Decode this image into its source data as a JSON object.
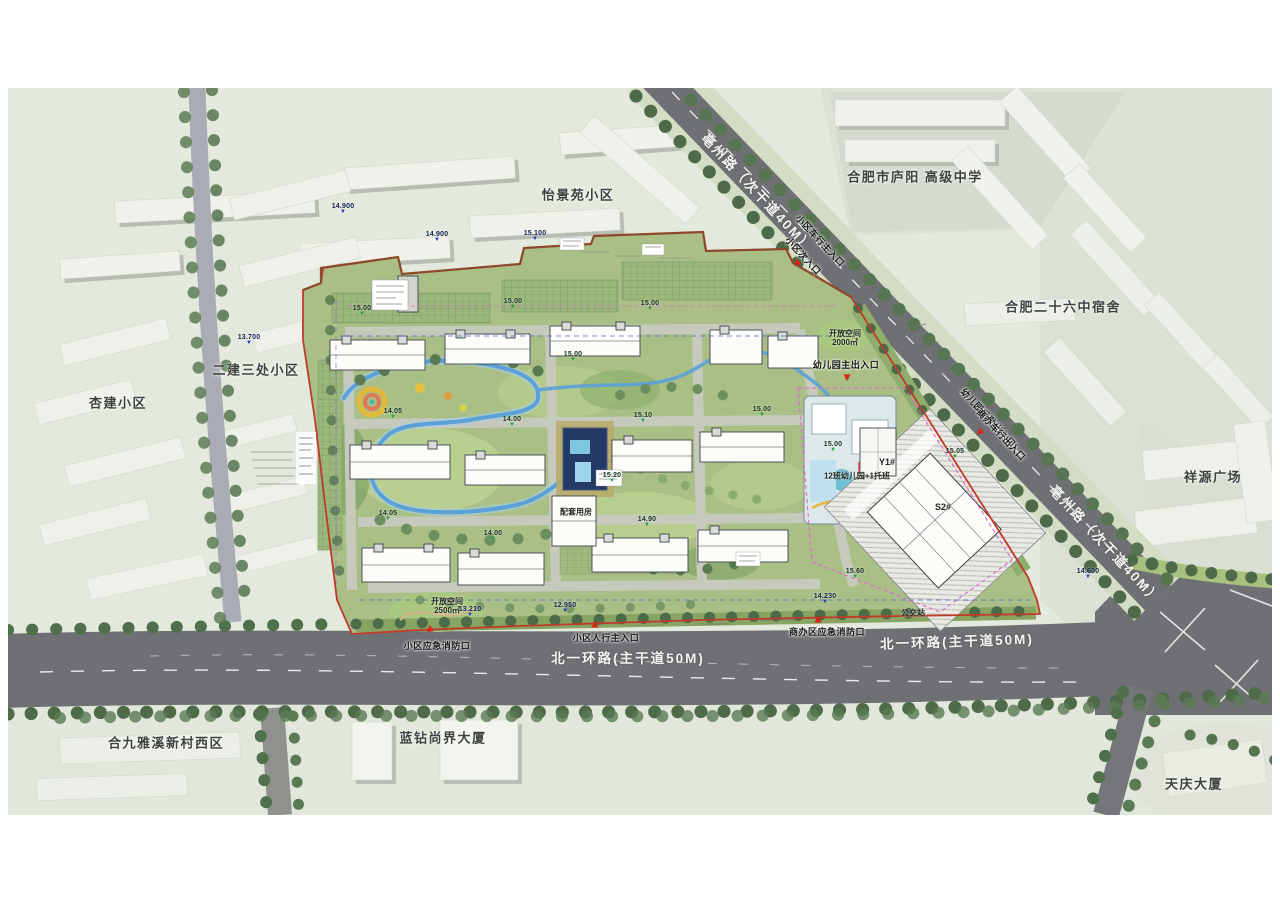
{
  "map": {
    "type": "residential-master-plan",
    "colors": {
      "paper": "#ffffff",
      "ground": "#e4e9dd",
      "ground_east": "#dde2d6",
      "road_major": "#6e7073",
      "road_minor": "#a9abb5",
      "site_green": "#a9bf86",
      "water": "#59a1d8",
      "boundary_red": "#c03a2b",
      "tree_green": "#4e6a49",
      "entrance_red": "#e3241c",
      "marker_green": "#1f9e44",
      "marker_blue": "#2433c9"
    }
  },
  "labels": {
    "areas": [
      {
        "text": "怡景苑小区",
        "x": 578,
        "y": 196,
        "rot": 0
      },
      {
        "text": "合肥市庐阳  高级中学",
        "x": 915,
        "y": 178,
        "rot": 0
      },
      {
        "text": "合肥二十六中宿舍",
        "x": 1063,
        "y": 308,
        "rot": 0
      },
      {
        "text": "祥源广场",
        "x": 1213,
        "y": 478,
        "rot": 0
      },
      {
        "text": "二建三处小区",
        "x": 256,
        "y": 371,
        "rot": 0
      },
      {
        "text": "杏建小区",
        "x": 118,
        "y": 404,
        "rot": 0
      },
      {
        "text": "合九雅溪新村西区",
        "x": 166,
        "y": 744,
        "rot": 0
      },
      {
        "text": "蓝钻尚界大厦",
        "x": 443,
        "y": 739,
        "rot": 0
      },
      {
        "text": "天庆大厦",
        "x": 1194,
        "y": 785,
        "rot": 0
      }
    ],
    "roads": [
      {
        "text": "亳州路（次干道40M）",
        "x": 757,
        "y": 193,
        "rot": 47
      },
      {
        "text": "亳州路（次干道40M）",
        "x": 1105,
        "y": 545,
        "rot": 47
      },
      {
        "text": "北一环路(主干道50M)",
        "x": 628,
        "y": 659,
        "rot": 0
      },
      {
        "text": "北一环路(主干道50M)",
        "x": 957,
        "y": 642,
        "rot": -2
      }
    ],
    "entrances": [
      {
        "text": "小区车行主入口",
        "x": 820,
        "y": 241,
        "rot": 47
      },
      {
        "text": "小区次入口",
        "x": 803,
        "y": 256,
        "rot": 47
      },
      {
        "text": "幼儿园主出入口",
        "x": 846,
        "y": 365,
        "rot": 0
      },
      {
        "text": "幼儿园后勤出入口/",
        "x": 989,
        "y": 419,
        "rot": 47
      },
      {
        "text": "商办车行出入口",
        "x": 1001,
        "y": 435,
        "rot": 47
      },
      {
        "text": "小区应急消防口",
        "x": 437,
        "y": 646,
        "rot": 0
      },
      {
        "text": "小区人行主入口",
        "x": 606,
        "y": 638,
        "rot": 0
      },
      {
        "text": "商办区应急消防口",
        "x": 827,
        "y": 632,
        "rot": 0
      }
    ],
    "site": [
      {
        "text": "开放空间\n2500㎡",
        "x": 447,
        "y": 606,
        "rot": 0
      },
      {
        "text": "开放空间\n2000㎡",
        "x": 845,
        "y": 338,
        "rot": 0
      },
      {
        "text": "公交站",
        "x": 913,
        "y": 613,
        "rot": 0
      },
      {
        "text": "12班幼儿园+1托班",
        "x": 857,
        "y": 476,
        "rot": 0
      },
      {
        "text": "配套用房",
        "x": 576,
        "y": 512,
        "rot": 0
      }
    ],
    "tags": [
      {
        "text": "Y1#",
        "x": 887,
        "y": 462,
        "rot": 0
      },
      {
        "text": "S2#",
        "x": 943,
        "y": 507,
        "rot": 0
      }
    ]
  },
  "entrance_triangles": [
    {
      "x": 797,
      "y": 263,
      "rot": 225
    },
    {
      "x": 847,
      "y": 377,
      "rot": 180
    },
    {
      "x": 980,
      "y": 432,
      "rot": 225
    },
    {
      "x": 430,
      "y": 629,
      "rot": 0
    },
    {
      "x": 595,
      "y": 625,
      "rot": 0
    },
    {
      "x": 818,
      "y": 620,
      "rot": 0
    }
  ],
  "elevation_markers": {
    "site": [
      {
        "x": 362,
        "y": 317,
        "v": "15.00"
      },
      {
        "x": 513,
        "y": 310,
        "v": "15.00"
      },
      {
        "x": 650,
        "y": 312,
        "v": "15.00"
      },
      {
        "x": 573,
        "y": 363,
        "v": "15.00"
      },
      {
        "x": 643,
        "y": 424,
        "v": "15.10"
      },
      {
        "x": 762,
        "y": 418,
        "v": "15.00"
      },
      {
        "x": 833,
        "y": 453,
        "v": "15.00"
      },
      {
        "x": 393,
        "y": 420,
        "v": "14.05"
      },
      {
        "x": 512,
        "y": 428,
        "v": "14.00"
      },
      {
        "x": 612,
        "y": 484,
        "v": "15.20"
      },
      {
        "x": 388,
        "y": 522,
        "v": "14.05"
      },
      {
        "x": 493,
        "y": 542,
        "v": "14.00"
      },
      {
        "x": 647,
        "y": 528,
        "v": "14.90"
      },
      {
        "x": 855,
        "y": 580,
        "v": "15.60"
      },
      {
        "x": 955,
        "y": 460,
        "v": "15.05"
      }
    ],
    "survey": [
      {
        "x": 343,
        "y": 215,
        "v": "14.900"
      },
      {
        "x": 437,
        "y": 243,
        "v": "14.900"
      },
      {
        "x": 535,
        "y": 242,
        "v": "15.100"
      },
      {
        "x": 249,
        "y": 346,
        "v": "13.700"
      },
      {
        "x": 470,
        "y": 618,
        "v": "13.210"
      },
      {
        "x": 565,
        "y": 614,
        "v": "12.950"
      },
      {
        "x": 825,
        "y": 605,
        "v": "14.230"
      },
      {
        "x": 1088,
        "y": 580,
        "v": "14.600"
      }
    ]
  }
}
